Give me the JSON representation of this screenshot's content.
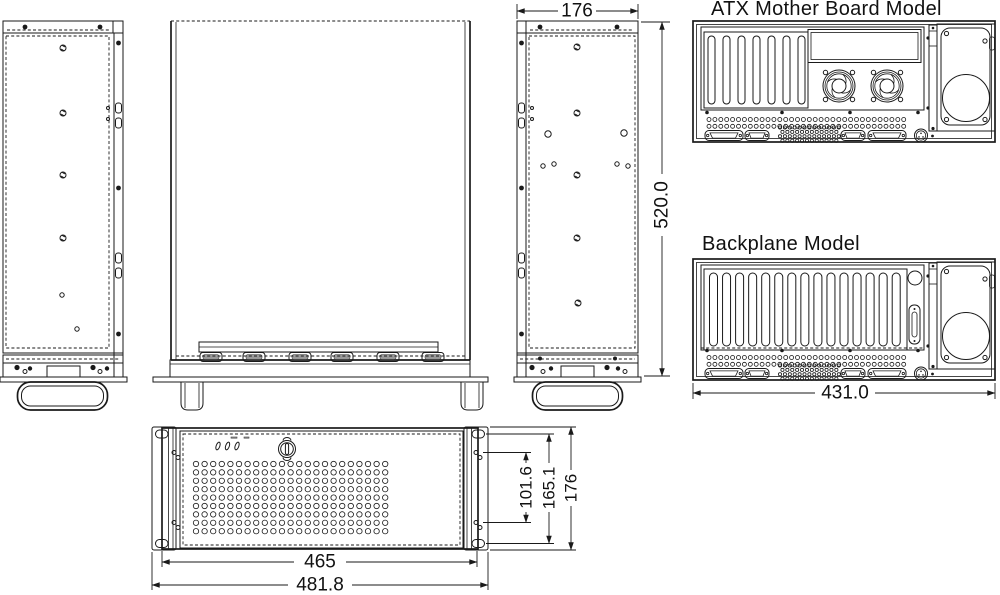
{
  "canvas": {
    "background": "#ffffff",
    "ink": "#1a1a1a"
  },
  "titles": {
    "atx": "ATX Mother Board Model",
    "backplane": "Backplane Model"
  },
  "dimensions": {
    "top_width": "176",
    "overall_height": "520.0",
    "rear_width": "431.0",
    "front_body_width": "465",
    "front_overall_width": "481.8",
    "front_rail_pitch": "101.6",
    "front_slot_pitch": "165.1",
    "front_height": "176"
  }
}
